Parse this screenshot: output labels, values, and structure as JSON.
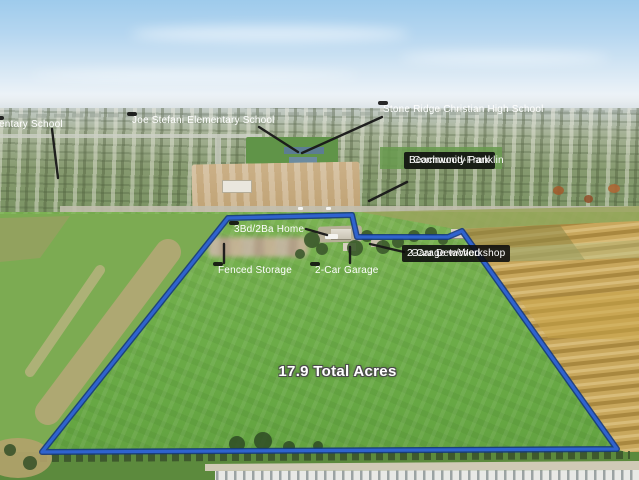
{
  "annotations": {
    "school_left_partial": "entary School",
    "school_joe_stefani": "Joe Stefani Elementary School",
    "school_stone_ridge": "Stone Ridge Christian High School",
    "park_line1": "Beachwood-Franklin",
    "park_line2": "Community Park",
    "home": "3Bd/2Ba Home",
    "fenced_storage": "Fenced Storage",
    "garage": "2-Car Garage",
    "detached_garage_line1": "2-Car Detached",
    "detached_garage_line2": "Garage w/Workshop",
    "acreage": "17.9 Total Acres"
  },
  "colors": {
    "boundary": "#2f63cf",
    "boundary_edge": "#14387f",
    "label_background": "#0c0c0c",
    "label_text": "#ffffff",
    "field_green": "#6fae4a",
    "sky_blue": "#9ecbec",
    "dirt_tan": "#c6ab80",
    "orchard_gold": "#c8a75c"
  }
}
